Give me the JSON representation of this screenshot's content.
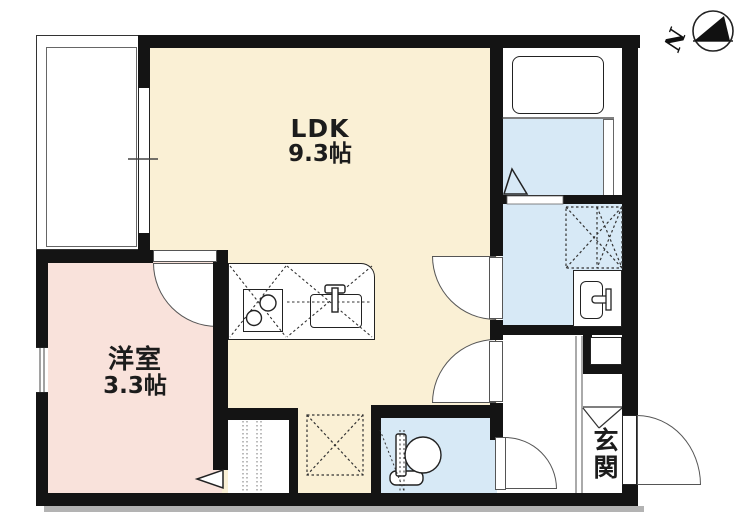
{
  "plan": {
    "title": "floor-plan",
    "compass_letter": "N",
    "rooms": {
      "ldk": {
        "label": "LDK",
        "size": "9.3帖"
      },
      "western_room": {
        "label": "洋室",
        "size": "3.3帖"
      },
      "entrance": {
        "label": "玄関"
      }
    },
    "colors": {
      "ldk_floor": "#FAF0D5",
      "western_room_floor": "#F9E2DB",
      "wet_area_floor": "#D7E9F6",
      "wall": "#141414"
    },
    "fixtures": [
      "balcony",
      "sliding-window",
      "kitchen-counter",
      "two-burner-stove",
      "kitchen-sink",
      "refrigerator-space-icon",
      "closet",
      "bathtub",
      "bathroom",
      "washing-machine-space-icon",
      "washbasin",
      "toilet",
      "shoe-cabinet",
      "entry-door",
      "north-arrow-icon"
    ]
  }
}
